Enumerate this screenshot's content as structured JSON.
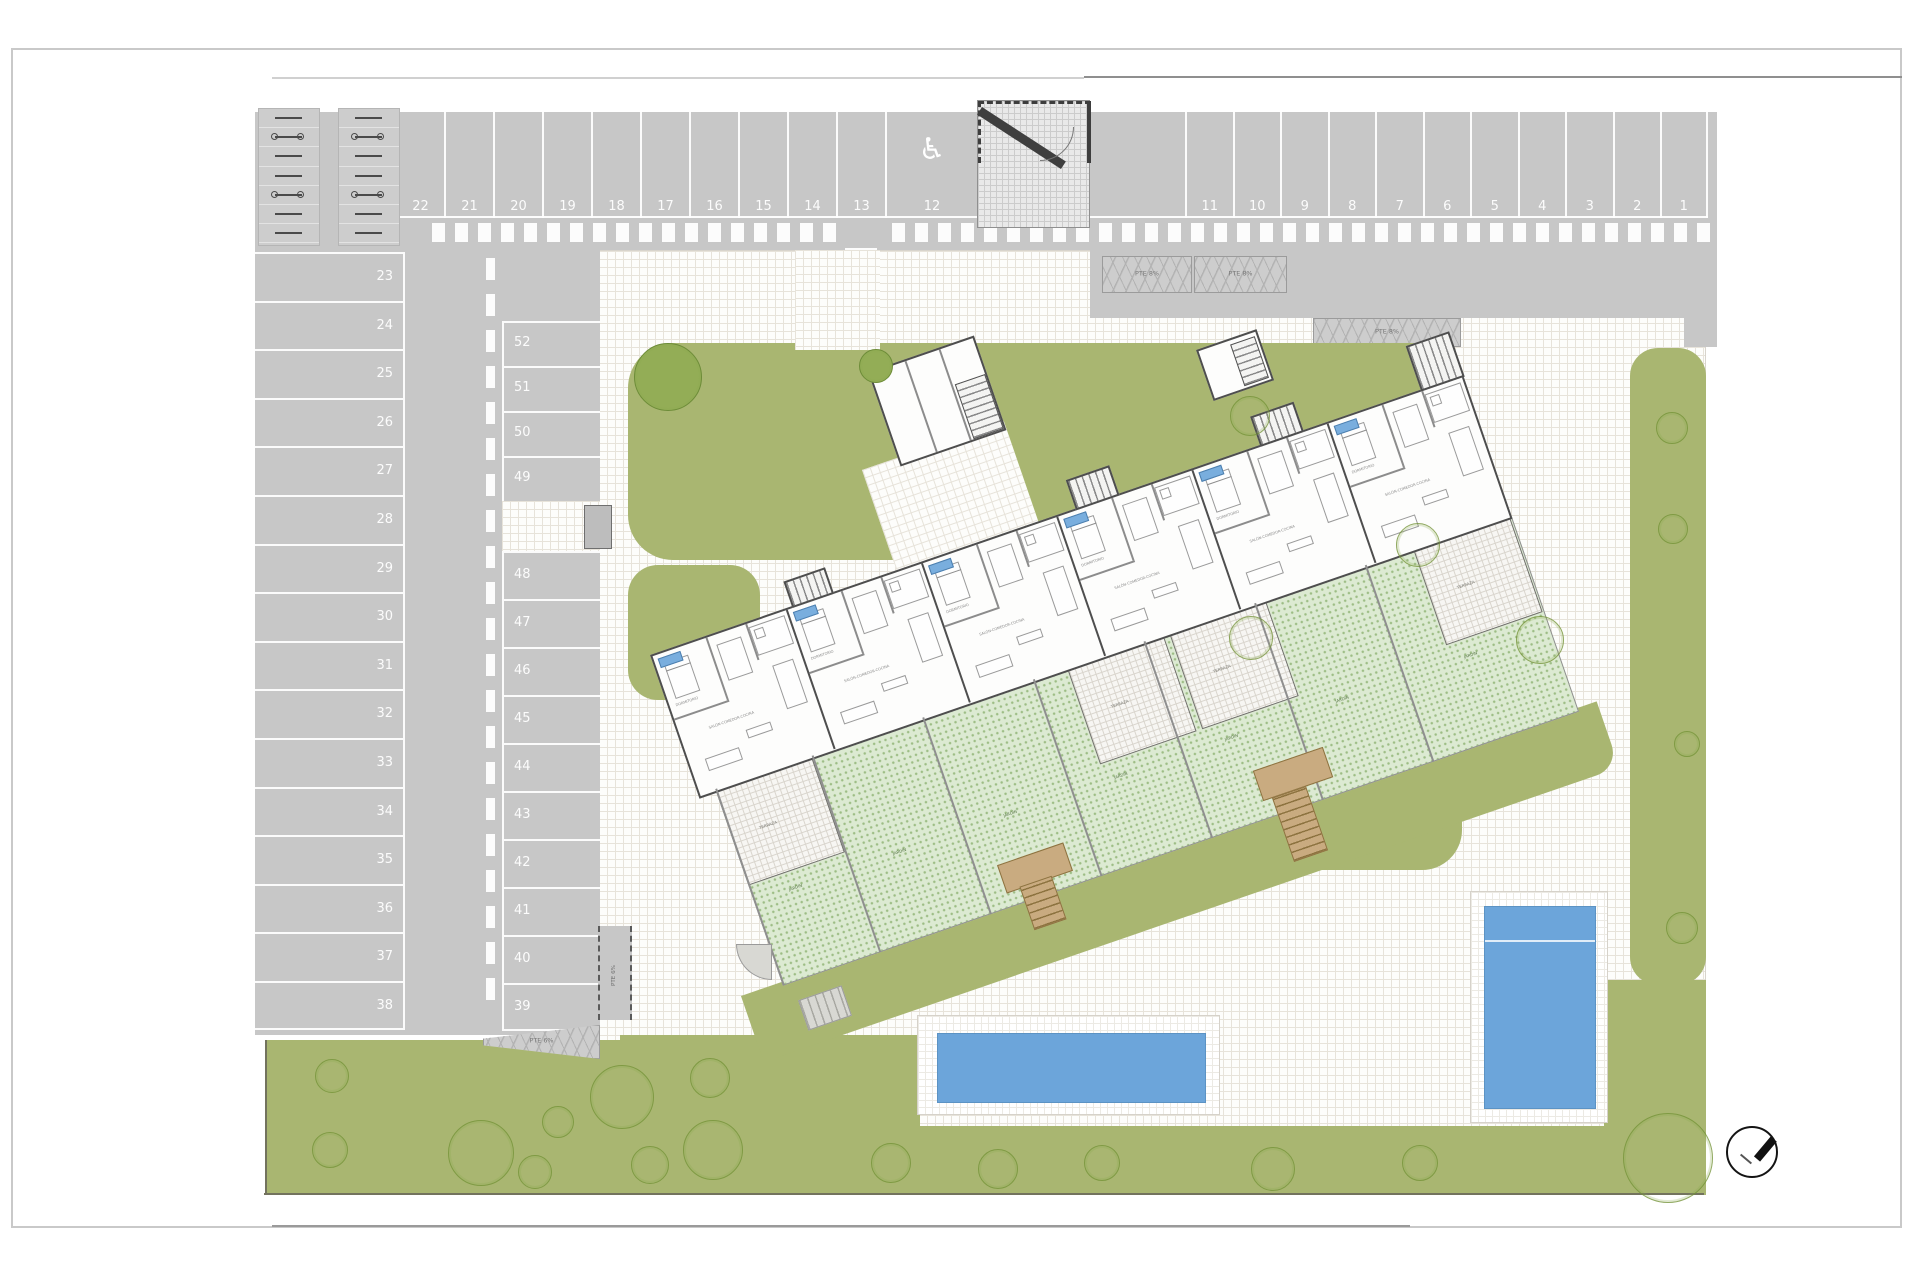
{
  "parking": {
    "top_row_left": [
      "22",
      "21",
      "20",
      "19",
      "18",
      "17",
      "16",
      "15",
      "14",
      "13"
    ],
    "accessible_space": {
      "number": "12",
      "icon": "♿"
    },
    "top_row_right": [
      "11",
      "10",
      "9",
      "8",
      "7",
      "6",
      "5",
      "4",
      "3",
      "2",
      "1"
    ],
    "left_column": [
      "23",
      "24",
      "25",
      "26",
      "27",
      "28",
      "29",
      "30",
      "31",
      "32",
      "33",
      "34",
      "35",
      "36",
      "37",
      "38"
    ],
    "middle_column_upper": [
      "52",
      "51",
      "50",
      "49"
    ],
    "middle_column_lower": [
      "48",
      "47",
      "46",
      "45",
      "44",
      "43",
      "42",
      "41",
      "40",
      "39"
    ]
  },
  "ramps": {
    "top_a": "PTE 8%",
    "top_b": "PTE 8%",
    "right": "PTE 8%",
    "lane": "PTE 6%",
    "bottom": "PTE 6%"
  },
  "building": {
    "unit_count": 6,
    "labels": {
      "living": "SALÓN-COMEDOR-COCINA",
      "bedroom": "DORMITORIO",
      "terrace": "TERRAZA",
      "garden": "JARDÍN"
    }
  },
  "trees": {
    "filled": [
      [
        668,
        377,
        34
      ],
      [
        876,
        366,
        17
      ]
    ],
    "outline": [
      [
        1250,
        416,
        20
      ],
      [
        1418,
        545,
        22
      ],
      [
        1540,
        640,
        24
      ],
      [
        1251,
        638,
        22
      ],
      [
        1672,
        428,
        16
      ],
      [
        1673,
        529,
        15
      ],
      [
        1687,
        744,
        13
      ],
      [
        1682,
        928,
        16
      ],
      [
        332,
        1076,
        17
      ],
      [
        330,
        1150,
        18
      ],
      [
        481,
        1153,
        33
      ],
      [
        535,
        1172,
        17
      ],
      [
        558,
        1122,
        16
      ],
      [
        622,
        1097,
        32
      ],
      [
        713,
        1150,
        30
      ],
      [
        650,
        1165,
        19
      ],
      [
        710,
        1078,
        20
      ],
      [
        891,
        1163,
        20
      ],
      [
        998,
        1169,
        20
      ],
      [
        1102,
        1163,
        18
      ],
      [
        1273,
        1169,
        22
      ],
      [
        1420,
        1163,
        18
      ],
      [
        1668,
        1158,
        45
      ]
    ]
  },
  "colors": {
    "road": "#c7c7c7",
    "lawn": "#a9b671",
    "garden": "#dcead2",
    "pool": "#6ca5da",
    "marking": "#ffffff"
  },
  "compass": {
    "icon": "north-needle"
  }
}
